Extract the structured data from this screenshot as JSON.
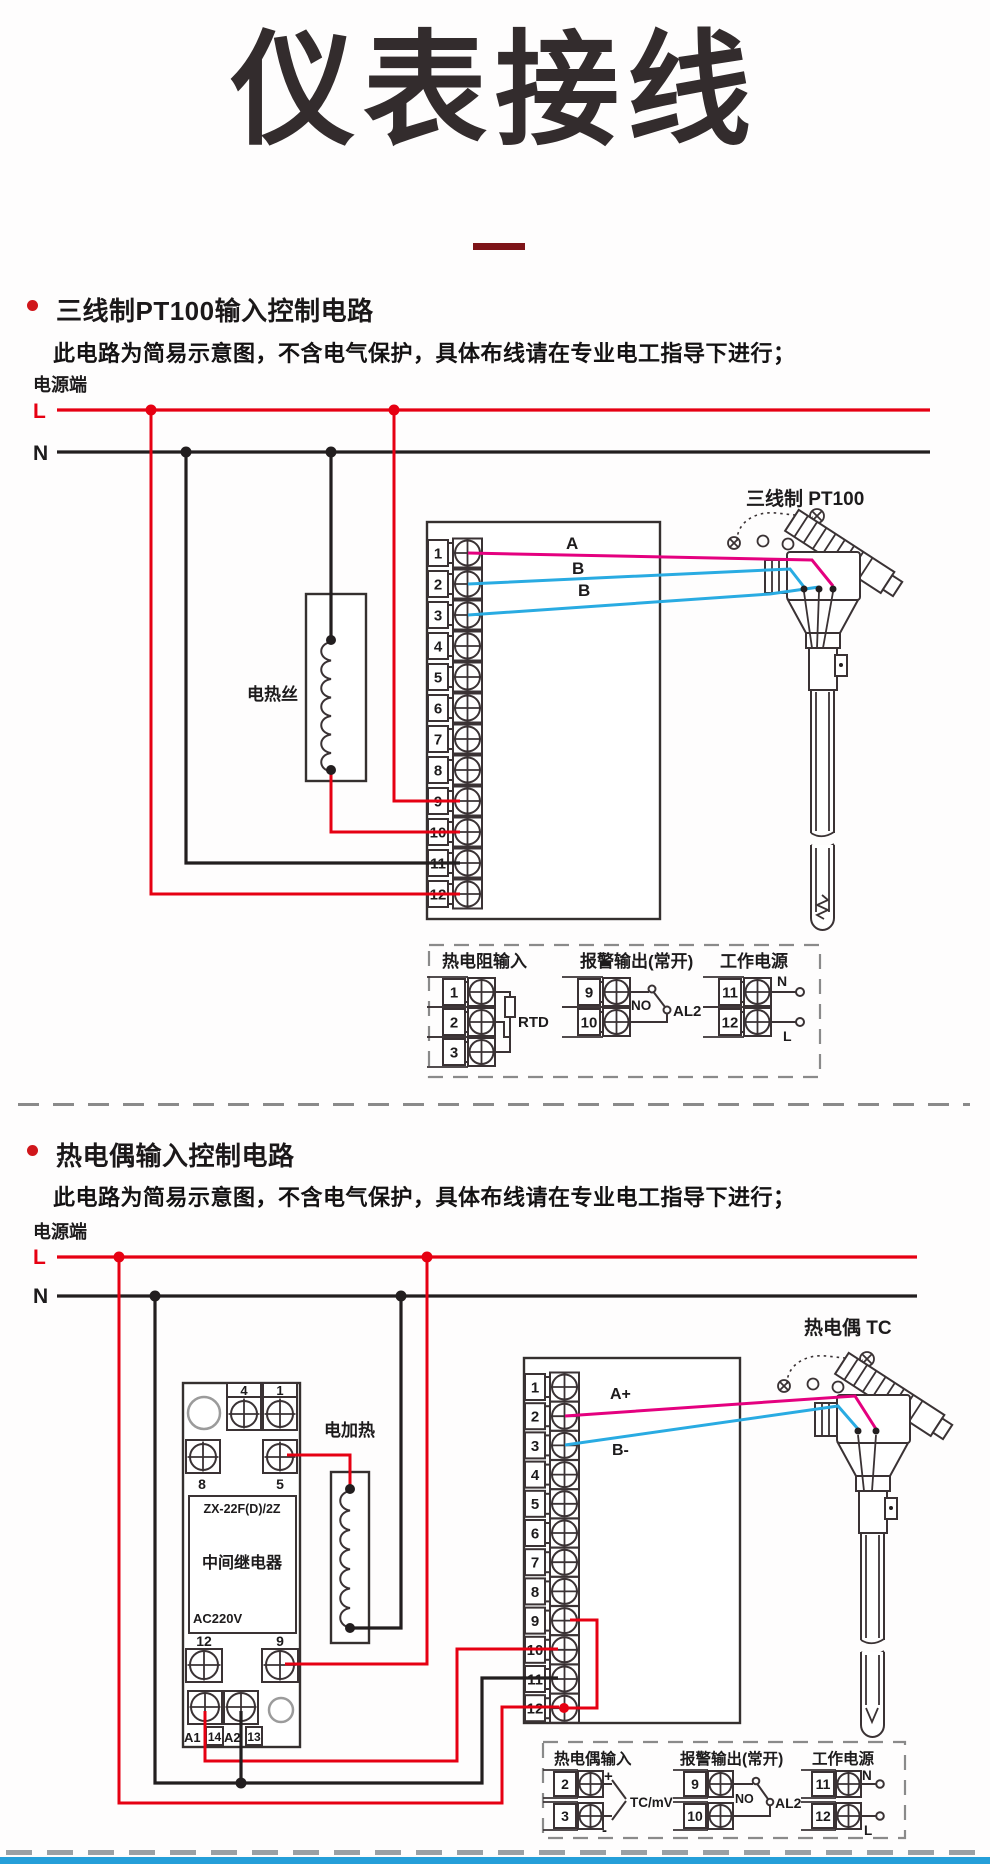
{
  "page": {
    "title": "仪表接线"
  },
  "colors": {
    "wire_red": "#e60012",
    "wire_mag": "#e4007f",
    "wire_blu": "#29abe2",
    "maroon": "#7e1418",
    "bullet": "#d0161b",
    "bar": "#259fd9"
  },
  "sections": [
    {
      "heading": "三线制PT100输入控制电路",
      "note": "此电路为简易示意图，不含电气保护，具体布线请在专业电工指导下进行；",
      "power_label": "电源端",
      "l": "L",
      "n": "N",
      "heater_label": "电热丝",
      "sensor_label": "三线制 PT100",
      "wire_labels": [
        "A",
        "B",
        "B"
      ],
      "terminals": [
        "1",
        "2",
        "3",
        "4",
        "5",
        "6",
        "7",
        "8",
        "9",
        "10",
        "11",
        "12"
      ],
      "legend": {
        "input_title": "热电阻输入",
        "input_terminals": [
          "1",
          "2",
          "3"
        ],
        "input_component": "RTD",
        "alarm_title": "报警输出(常开)",
        "alarm_terminals": [
          "9",
          "10"
        ],
        "alarm_no": "NO",
        "alarm_name": "AL2",
        "power_title": "工作电源",
        "power_terminals": [
          "11",
          "12"
        ],
        "power_n": "N",
        "power_l": "L"
      }
    },
    {
      "heading": "热电偶输入控制电路",
      "note": "此电路为简易示意图，不含电气保护，具体布线请在专业电工指导下进行；",
      "power_label": "电源端",
      "l": "L",
      "n": "N",
      "heater_label": "电加热",
      "sensor_label": "热电偶 TC",
      "wire_labels": [
        "A+",
        "B-"
      ],
      "terminals": [
        "1",
        "2",
        "3",
        "4",
        "5",
        "6",
        "7",
        "8",
        "9",
        "10",
        "11",
        "12"
      ],
      "relay": {
        "model": "ZX-22F(D)/2Z",
        "name": "中间继电器",
        "voltage": "AC220V",
        "t4": "4",
        "t1": "1",
        "t8": "8",
        "t5": "5",
        "t12": "12",
        "t9": "9",
        "a1": "A1",
        "n14": "14",
        "a2": "A2",
        "n13": "13"
      },
      "legend": {
        "input_title": "热电偶输入",
        "input_terminals": [
          "2",
          "3"
        ],
        "input_plus": "+",
        "input_minus": "-",
        "input_component": "TC/mV",
        "alarm_title": "报警输出(常开)",
        "alarm_terminals": [
          "9",
          "10"
        ],
        "alarm_no": "NO",
        "alarm_name": "AL2",
        "power_title": "工作电源",
        "power_terminals": [
          "11",
          "12"
        ],
        "power_n": "N",
        "power_l": "L"
      }
    }
  ]
}
